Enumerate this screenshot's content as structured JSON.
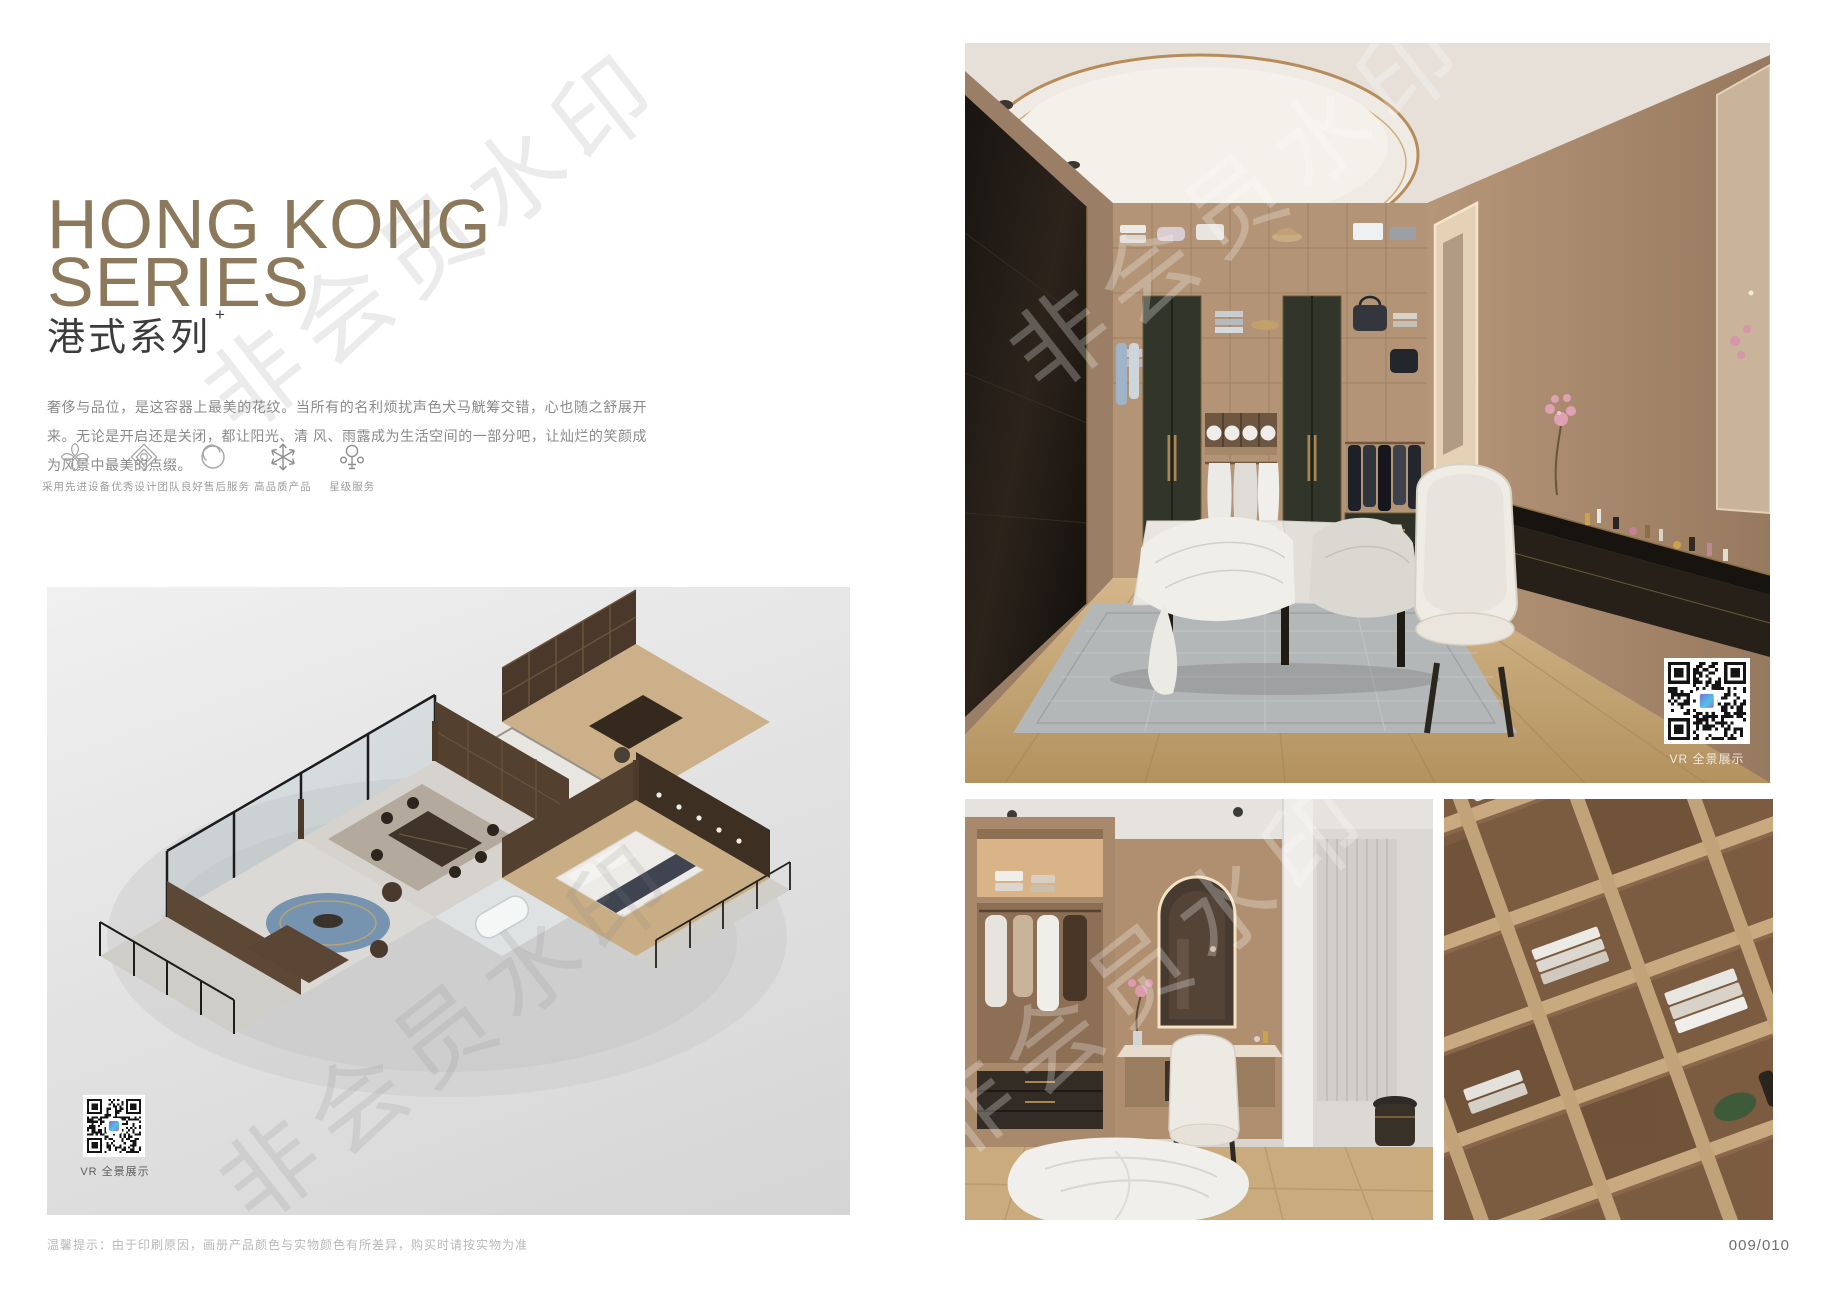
{
  "title": {
    "line1": "HONG KONG",
    "line2": "SERIES",
    "subtitle": "港式系列",
    "superscript": "+"
  },
  "description": {
    "line1": "奢侈与品位，是这容器上最美的花纹。当所有的名利烦扰声色犬马觥筹交错，心也随之舒展开来。无论是开启还是关闭，都让阳光、清",
    "line2": "风、雨露成为生活空间的一部分吧，让灿烂的笑颜成为风景中最美的点缀。"
  },
  "features": [
    {
      "icon": "pinwheel-icon",
      "label": "采用先进设备"
    },
    {
      "icon": "ornament-icon",
      "label": "优秀设计团队"
    },
    {
      "icon": "ring-icon",
      "label": "良好售后服务"
    },
    {
      "icon": "snowflake-icon",
      "label": "高品质产品"
    },
    {
      "icon": "key-star-icon",
      "label": "星级服务"
    }
  ],
  "vr_label": "VR 全景展示",
  "footer": {
    "note": "温馨提示：由于印刷原因，画册产品颜色与实物颜色有所差异，购买时请按实物为准",
    "page_number": "009/010"
  },
  "watermark": {
    "text": "非会员水印"
  },
  "colors": {
    "title_tan": "#8c795b",
    "accent_gold": "#b68d5a",
    "panel_gray_top": "#f0f0f0",
    "panel_gray_bottom": "#d5d5d5",
    "wood_floor": "#c9ad81",
    "dark_wardrobe": "#1b1712",
    "green_wardrobe": "#32362a"
  }
}
